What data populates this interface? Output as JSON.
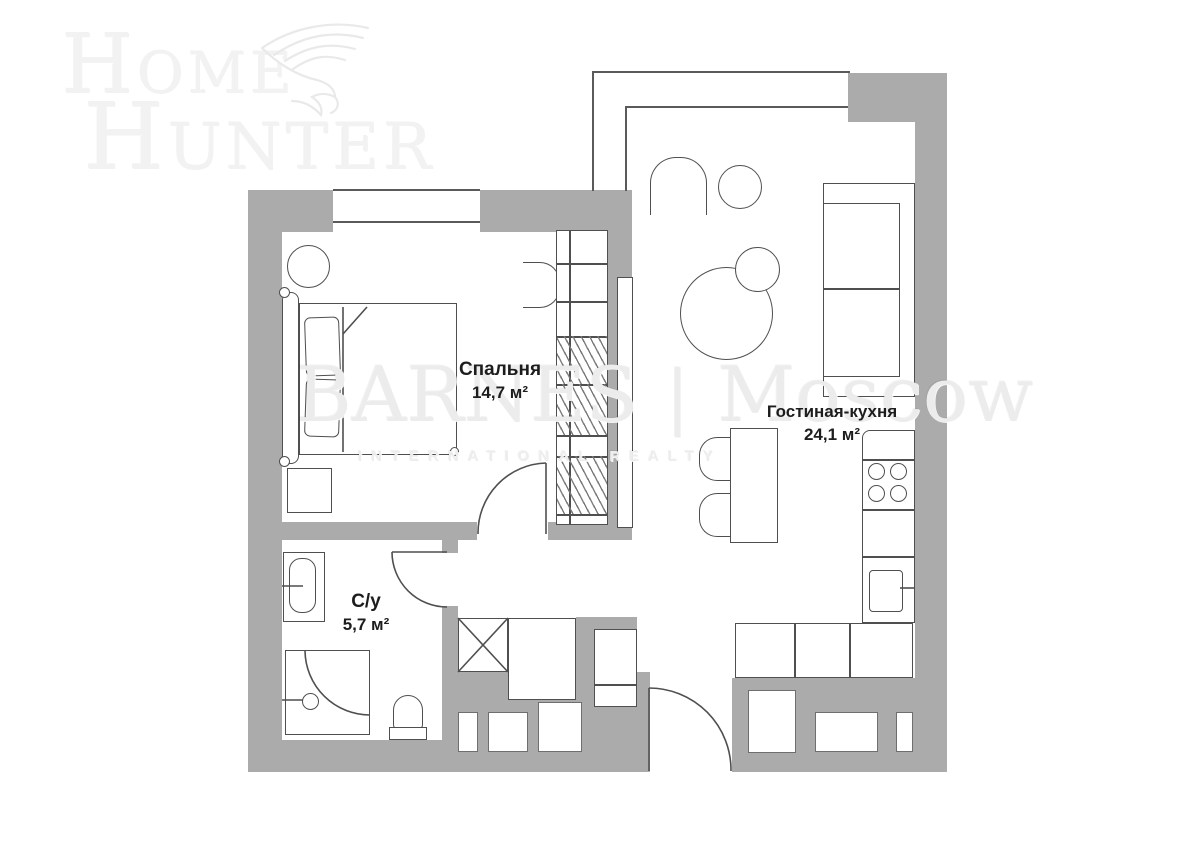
{
  "watermarks": {
    "logo": {
      "line1": "Home",
      "line2": "Hunter"
    },
    "brand": {
      "name": "BARNES",
      "separator": "|",
      "city": "Moscow",
      "tagline": "INTERNATIONAL REALTY"
    }
  },
  "plan": {
    "rooms": [
      {
        "name": "Спальня",
        "area": "14,7 м²"
      },
      {
        "name": "Гостиная-кухня",
        "area": "24,1 м²"
      },
      {
        "name": "С/у",
        "area": "5,7 м²"
      }
    ]
  },
  "colors": {
    "wall": "#ababab",
    "outline": "#4f4f4f",
    "label_text": "#1d1d1d",
    "watermark_gray": "#ededed"
  }
}
